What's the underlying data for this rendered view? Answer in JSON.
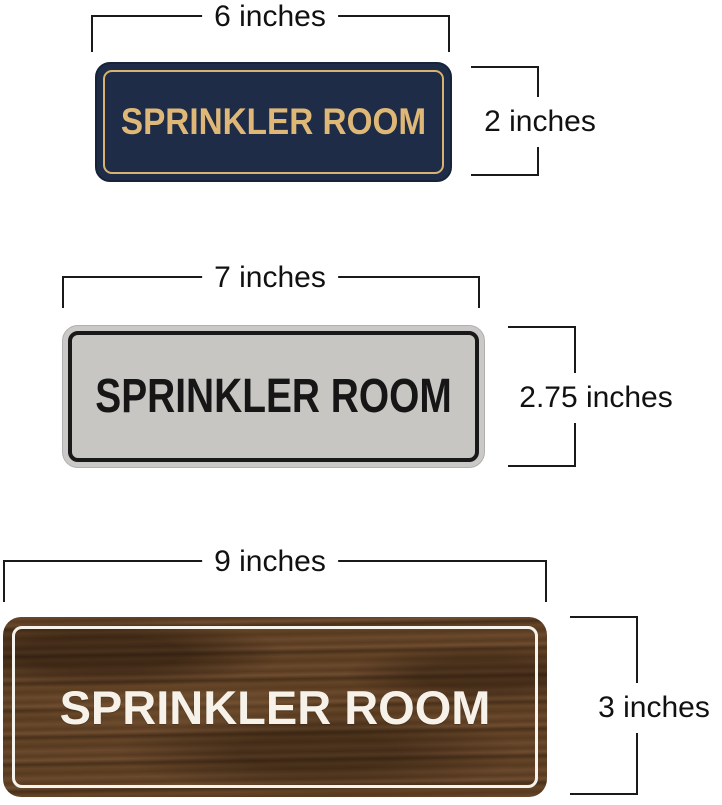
{
  "signs": [
    {
      "name": "navy-gold-sign",
      "text": "SPRINKLER ROOM",
      "width_label": "6 inches",
      "height_label": "2 inches",
      "colors": {
        "background": "#1e2c47",
        "border": "#d8b26e",
        "text": "#dfb877"
      }
    },
    {
      "name": "silver-black-sign",
      "text": "SPRINKLER ROOM",
      "width_label": "7 inches",
      "height_label": "2.75 inches",
      "colors": {
        "background": "#c8c8c6",
        "border": "#191919",
        "text": "#161616"
      }
    },
    {
      "name": "walnut-wood-sign",
      "text": "SPRINKLER ROOM",
      "width_label": "9 inches",
      "height_label": "3 inches",
      "colors": {
        "background": "#5a3d24",
        "border": "#f6f3ec",
        "text": "#f6f2e9"
      }
    }
  ],
  "annotation_color": "#1a1a1a"
}
